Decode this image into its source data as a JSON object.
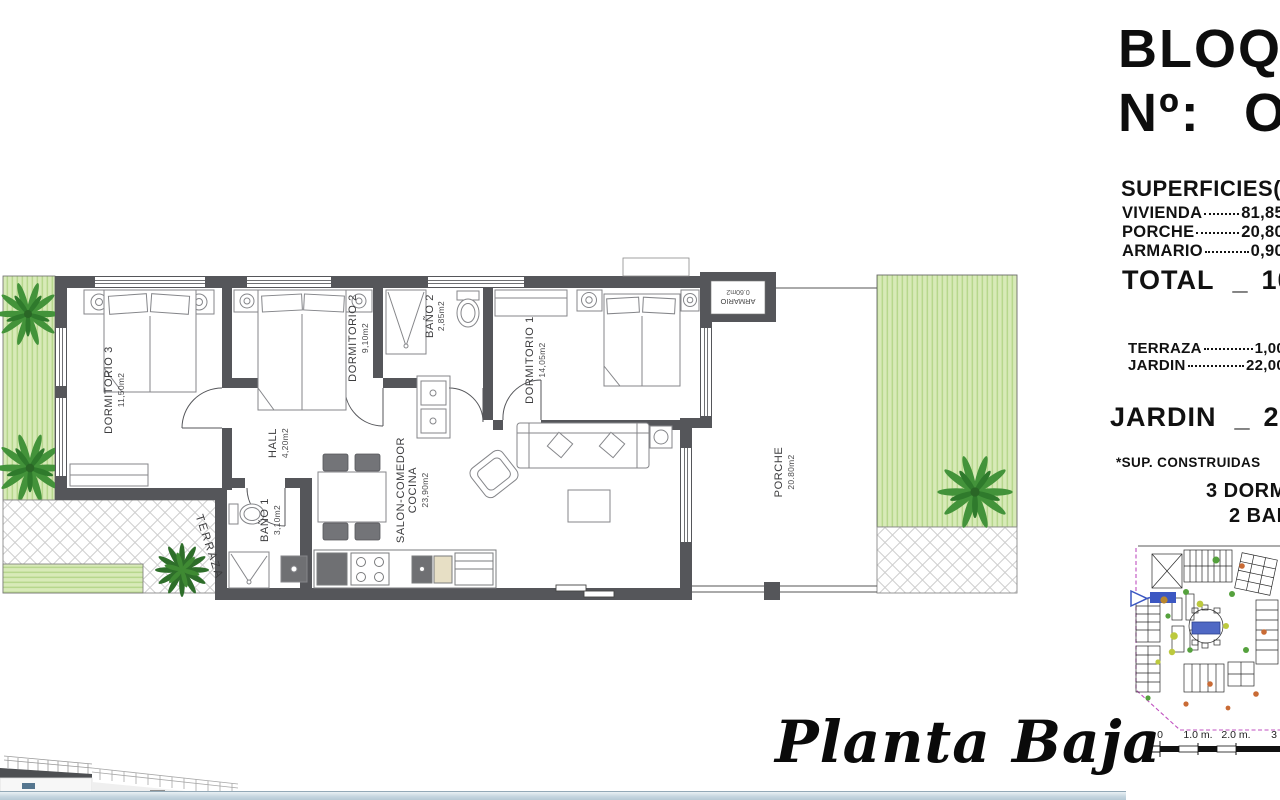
{
  "header": {
    "block_label": "BLOQ.",
    "number_label": "Nº:",
    "number_value": "O"
  },
  "surfaces": {
    "title": "SUPERFICIES(M",
    "rows": [
      {
        "label": "VIVIENDA",
        "value": "81,85"
      },
      {
        "label": "PORCHE",
        "value": "20,80"
      },
      {
        "label": "ARMARIO",
        "value": "0,90"
      }
    ],
    "total": {
      "label": "TOTAL",
      "sep": "_",
      "value": "103,5"
    },
    "outdoor_rows": [
      {
        "label": "TERRAZA",
        "value": "1,00"
      },
      {
        "label": "JARDIN",
        "value": "22,00"
      }
    ],
    "jardin_total": {
      "label": "JARDIN",
      "sep": "_",
      "value": "23,00"
    },
    "note": "*SUP. CONSTRUIDAS",
    "features": [
      "3 DORMITORIOS",
      "2 BAÑOS"
    ]
  },
  "plan": {
    "rooms": {
      "dormitorio3": {
        "name": "DORMITORIO 3",
        "area": "11,50m2"
      },
      "dormitorio2": {
        "name": "DORMITORIO 2",
        "area": "9,10m2"
      },
      "bano2": {
        "name": "BAÑO 2",
        "area": "2,85m2"
      },
      "dormitorio1": {
        "name": "DORMITORIO 1",
        "area": "14,05m2"
      },
      "armario": {
        "name": "ARMARIO",
        "area": "0.60m2"
      },
      "hall": {
        "name": "HALL",
        "area": "4,20m2"
      },
      "bano1": {
        "name": "BAÑO 1",
        "area": "3,10m2"
      },
      "salon": {
        "name": "SALON-COMEDOR",
        "name2": "COCINA",
        "area": "23,90m2"
      },
      "terraza": {
        "name": "TERRAZA"
      },
      "porche": {
        "name": "PORCHE",
        "area": "20.80m2"
      }
    }
  },
  "footer": {
    "plan_title": "Planta Baja"
  },
  "scalebar": {
    "ticks": [
      "0",
      "1.0 m.",
      "2.0 m.",
      "3"
    ]
  },
  "colors": {
    "wall": "#55565a",
    "garden": "#d8eab8",
    "garden_stripe": "#b7d78d",
    "pool": "#4f68c4",
    "boundary": "#c050c0",
    "bottom_bar": "#c3d4de",
    "unit_highlight": "#3c57c2"
  }
}
